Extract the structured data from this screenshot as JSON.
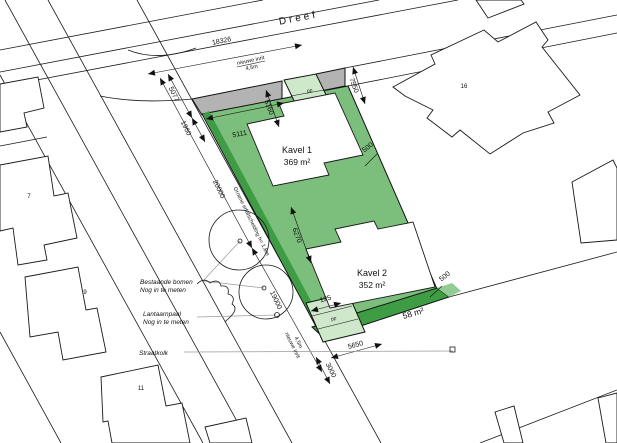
{
  "street": {
    "name": "Dreef"
  },
  "parcels": {
    "kavel1": {
      "label": "Kavel 1",
      "area": "369 m²"
    },
    "kavel2": {
      "label": "Kavel 2",
      "area": "352 m²"
    },
    "rest_strip": {
      "area": "58 m²"
    }
  },
  "house_numbers": {
    "left_top": "7",
    "left_mid": "9",
    "left_bottom": "11",
    "right": "16"
  },
  "dimensions": {
    "dreef_length": "18326",
    "road_seg1": "5077",
    "road_seg2": "1960",
    "plot_top_width": "5111",
    "plot_top_depth": "5160",
    "driveway_offset": "7550",
    "kavel1_edge_offset": "500",
    "kavel2_length": "6270",
    "road_span1": "20000",
    "road_span2": "19000",
    "parking_offset": "125",
    "kavel2_edge_offset": "500",
    "parking_width": "5650",
    "driveway_width": "3000"
  },
  "annotations": {
    "new_driveway_top": [
      "nieuwe inrit",
      "4,5m"
    ],
    "new_driveway_bottom": [
      "nieuwe inrit",
      "4,5m"
    ],
    "green_fence": "Groene erfafscheiding h= 1,8m",
    "existing_trees": [
      "Bestaande bomen",
      "Nog in te meten"
    ],
    "lamppost": [
      "Lantaarnpaal",
      "Nog in te meten"
    ],
    "street_gully": "Straatkolk",
    "parking_top": "pp",
    "parking_bottom": "pp"
  },
  "colors": {
    "plot_green": "#7CBE7C",
    "dark_green": "#3E9C44",
    "light_green": "#CFE7CA",
    "pale_green": "#93CC93",
    "verge_gray": "#B3B3B3"
  }
}
